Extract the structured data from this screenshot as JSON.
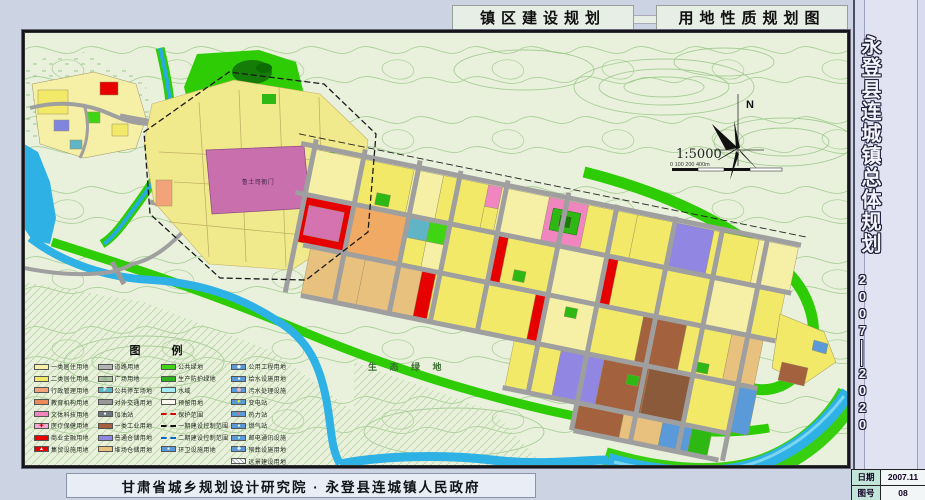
{
  "header": {
    "tab_left": "镇区建设规划",
    "tab_right": "用地性质规划图"
  },
  "sidebar": {
    "title": "永登县连城镇总体规划",
    "period_top": "2007",
    "period_dash": "——",
    "period_bottom": "2020",
    "info": {
      "date_label": "日期",
      "date_value": "2007.11",
      "sheet_label": "图号",
      "sheet_value": "08"
    }
  },
  "footer": {
    "credit": "甘肃省城乡规划设计研究院 · 永登县连城镇人民政府"
  },
  "map": {
    "north_label": "N",
    "scale_text": "1:5000",
    "scale_bar_ticks": "0   100   200              400m",
    "eco_label": "生 态 绿 地",
    "old_town_label": "鲁土司衙门"
  },
  "legend": {
    "title": "图  例",
    "columns": [
      {
        "items": [
          {
            "label": "一类居住用地",
            "swatch": {
              "kind": "box",
              "fill": "#f7f1a8"
            }
          },
          {
            "label": "二类居住用地",
            "swatch": {
              "kind": "box",
              "fill": "#f3e969"
            }
          },
          {
            "label": "行政管理用地",
            "swatch": {
              "kind": "box",
              "fill": "#f2a379"
            }
          },
          {
            "label": "教育机构用地",
            "swatch": {
              "kind": "box",
              "fill": "#ea8a5a"
            }
          },
          {
            "label": "文体科技用地",
            "swatch": {
              "kind": "box",
              "fill": "#ef86c0"
            }
          },
          {
            "label": "医疗保健用地",
            "swatch": {
              "kind": "box",
              "fill": "#f6a8d0",
              "icon": "✚",
              "iconColor": "#c00"
            }
          },
          {
            "label": "商业金融用地",
            "swatch": {
              "kind": "box",
              "fill": "#e60000"
            }
          },
          {
            "label": "集贸设施用地",
            "swatch": {
              "kind": "box",
              "fill": "#e60000",
              "icon": "▲",
              "iconColor": "#fff"
            }
          }
        ]
      },
      {
        "items": [
          {
            "label": "道路用地",
            "swatch": {
              "kind": "box",
              "fill": "#b3b3b3"
            }
          },
          {
            "label": "广场用地",
            "swatch": {
              "kind": "box",
              "fill": "#a9bfa0",
              "icon": "∷",
              "iconColor": "#2a7a2a"
            }
          },
          {
            "label": "公共停车场地",
            "swatch": {
              "kind": "box",
              "fill": "#5fb4c6",
              "icon": "P",
              "iconColor": "#fff"
            }
          },
          {
            "label": "对外交通用地",
            "swatch": {
              "kind": "box",
              "fill": "#989898"
            }
          },
          {
            "label": "加油站",
            "swatch": {
              "kind": "box",
              "fill": "#6e7a82",
              "icon": "●",
              "iconColor": "#fff"
            }
          },
          {
            "label": "一类工业用地",
            "swatch": {
              "kind": "box",
              "fill": "#a3613d"
            }
          },
          {
            "label": "普通仓储用地",
            "swatch": {
              "kind": "box",
              "fill": "#9186e2"
            }
          },
          {
            "label": "堆场仓储用地",
            "swatch": {
              "kind": "box",
              "fill": "#e9c17f"
            }
          }
        ]
      },
      {
        "items": [
          {
            "label": "公共绿地",
            "swatch": {
              "kind": "box",
              "fill": "#3fd414"
            }
          },
          {
            "label": "生产防护绿地",
            "swatch": {
              "kind": "box",
              "fill": "#2bb51a"
            }
          },
          {
            "label": "水域",
            "swatch": {
              "kind": "box",
              "fill": "#a5ebf5"
            }
          },
          {
            "label": "预留用地",
            "swatch": {
              "kind": "box",
              "fill": "#f8f8ef"
            }
          },
          {
            "label": "保护范围",
            "swatch": {
              "kind": "line-red"
            }
          },
          {
            "label": "一期建设控制范围",
            "swatch": {
              "kind": "line-black"
            }
          },
          {
            "label": "二期建设控制范围",
            "swatch": {
              "kind": "line-blue"
            }
          },
          {
            "label": "环卫设施用地",
            "swatch": {
              "kind": "box",
              "fill": "#5a9ad8",
              "icon": "●",
              "iconColor": "#fff"
            }
          }
        ]
      },
      {
        "items": [
          {
            "label": "公用工程用地",
            "swatch": {
              "kind": "box",
              "fill": "#5a9ad8",
              "icon": "◆",
              "iconColor": "#fff"
            }
          },
          {
            "label": "给水设施用地",
            "swatch": {
              "kind": "box",
              "fill": "#5a9ad8",
              "icon": "●",
              "iconColor": "#fff"
            }
          },
          {
            "label": "污水处理设施",
            "swatch": {
              "kind": "box",
              "fill": "#5a9ad8",
              "icon": "◉",
              "iconColor": "#fbb"
            }
          },
          {
            "label": "变电站",
            "swatch": {
              "kind": "box",
              "fill": "#5a9ad8",
              "icon": "✦",
              "iconColor": "#ff0"
            }
          },
          {
            "label": "热力站",
            "swatch": {
              "kind": "box",
              "fill": "#5a9ad8",
              "icon": "●",
              "iconColor": "#f66"
            }
          },
          {
            "label": "燃气站",
            "swatch": {
              "kind": "box",
              "fill": "#5a9ad8",
              "icon": "●",
              "iconColor": "#ffa"
            }
          },
          {
            "label": "邮电通讯设施",
            "swatch": {
              "kind": "box",
              "fill": "#5a9ad8",
              "icon": "●",
              "iconColor": "#cfe"
            }
          },
          {
            "label": "殡葬设施用地",
            "swatch": {
              "kind": "box",
              "fill": "#5a9ad8",
              "icon": "✚",
              "iconColor": "#fff"
            }
          },
          {
            "label": "远景建设用地",
            "swatch": {
              "kind": "hatch"
            }
          }
        ]
      }
    ]
  },
  "palette": {
    "page_bg": "#ccd3e2",
    "map_bg": "#e9f1dc",
    "contour_line": "#a9cf97",
    "green_belt": "#2ecc05",
    "water": "#2eb2e6",
    "road": "#9f9f9f",
    "commercial_red": "#e60000",
    "sidebar_bg": "#d9dcee"
  }
}
